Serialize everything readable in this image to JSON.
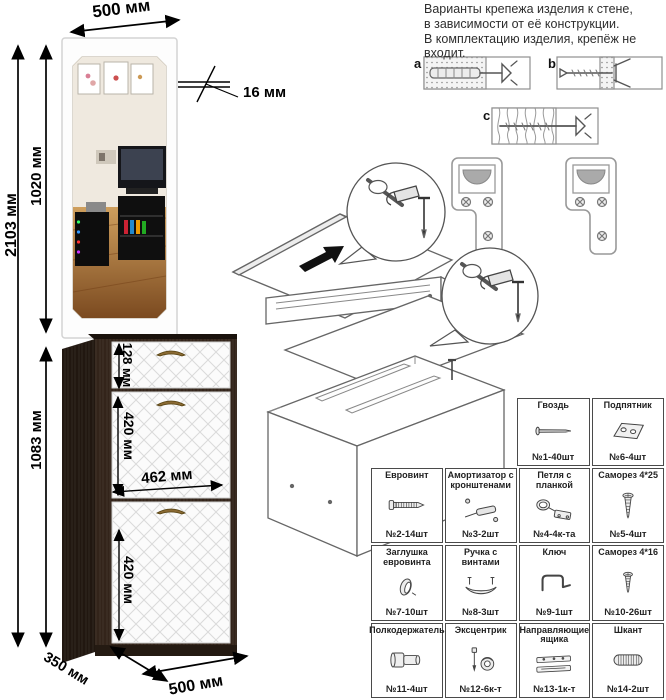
{
  "info": {
    "lines": [
      "Варианты крепежа изделия к стене,",
      "в зависимости от её конструкции.",
      "В комплектацию изделия, крепёж не",
      "входит."
    ]
  },
  "dimensions": {
    "width_top": "500 мм",
    "thickness": "16 мм",
    "total_height": "2103 мм",
    "mirror_height": "1020 мм",
    "cabinet_height": "1083 мм",
    "drawer_height": "128 мм",
    "door1_height": "420 мм",
    "inner_width": "462 мм",
    "door2_height": "420 мм",
    "depth": "350 мм",
    "width_bottom": "500 мм"
  },
  "wall_options": {
    "a": "a",
    "b": "b",
    "c": "c"
  },
  "colors": {
    "cabinet_body": "#33241a",
    "cabinet_side": "#211710",
    "door_front": "#fafafa",
    "handle": "#8a6a33",
    "floor_wood": "#b07a3c",
    "dimension_ink": "#000000"
  },
  "parts": {
    "top": [
      {
        "label": "Гвоздь",
        "qty": "№1-40шт",
        "icon": "nail"
      },
      {
        "label": "Подпятник",
        "qty": "№6-4шт",
        "icon": "heel"
      }
    ],
    "main": [
      {
        "label": "Евровинт",
        "qty": "№2-14шт",
        "icon": "confirmat"
      },
      {
        "label": "Амортизатор с кронштенами",
        "qty": "№3-2шт",
        "icon": "damper"
      },
      {
        "label": "Петля с планкой",
        "qty": "№4-4к-та",
        "icon": "hinge"
      },
      {
        "label": "Саморез 4*25",
        "qty": "№5-4шт",
        "icon": "screw25"
      },
      {
        "label": "Заглушка евровинта",
        "qty": "№7-10шт",
        "icon": "cap"
      },
      {
        "label": "Ручка с винтами",
        "qty": "№8-3шт",
        "icon": "handle"
      },
      {
        "label": "Ключ",
        "qty": "№9-1шт",
        "icon": "hexkey"
      },
      {
        "label": "Саморез 4*16",
        "qty": "№10-26шт",
        "icon": "screw16"
      },
      {
        "label": "Полкодержатель",
        "qty": "№11-4шт",
        "icon": "shelfsup"
      },
      {
        "label": "Эксцентрик",
        "qty": "№12-6к-т",
        "icon": "cam"
      },
      {
        "label": "Направляющие ящика",
        "qty": "№13-1к-т",
        "icon": "slides"
      },
      {
        "label": "Шкант",
        "qty": "№14-2шт",
        "icon": "dowel"
      }
    ]
  }
}
